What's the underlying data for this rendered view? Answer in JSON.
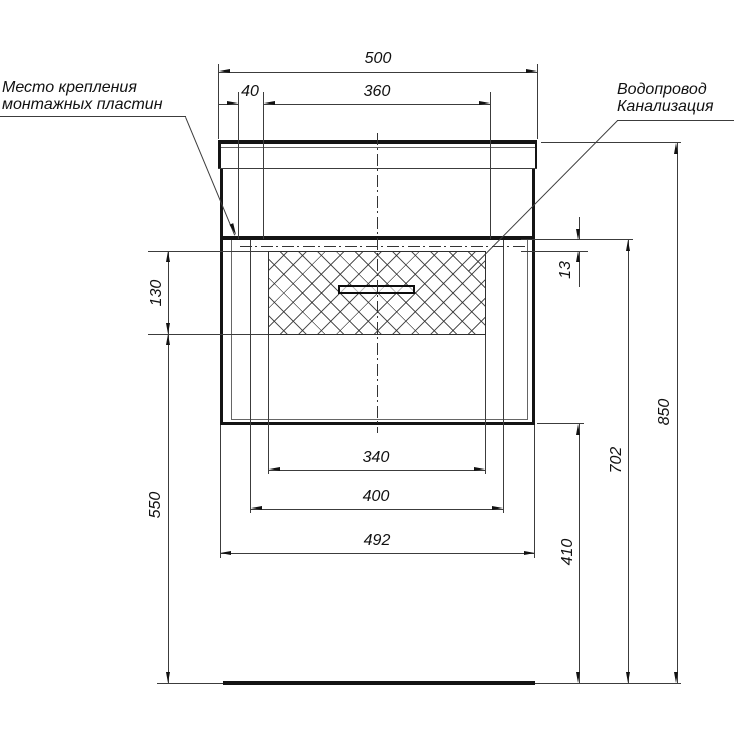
{
  "drawing": {
    "labels": {
      "mounting_plates": {
        "line1": "Место крепления",
        "line2": "монтажных пластин"
      },
      "utilities": {
        "line1": "Водопровод",
        "line2": "Канализация"
      }
    },
    "dimensions": {
      "countertop_width": "500",
      "plate_offset": "40",
      "plate_spacing": "360",
      "opening_width": "340",
      "drawer_width": "400",
      "cabinet_width": "492",
      "drawer_front_height": "130",
      "floor_clearance": "550",
      "top_gap": "13",
      "bottom_height": "410",
      "mount_height": "702",
      "total_height": "850"
    },
    "colors": {
      "line": "#141414",
      "thin_line": "#3c3c3c",
      "background": "#ffffff"
    }
  }
}
